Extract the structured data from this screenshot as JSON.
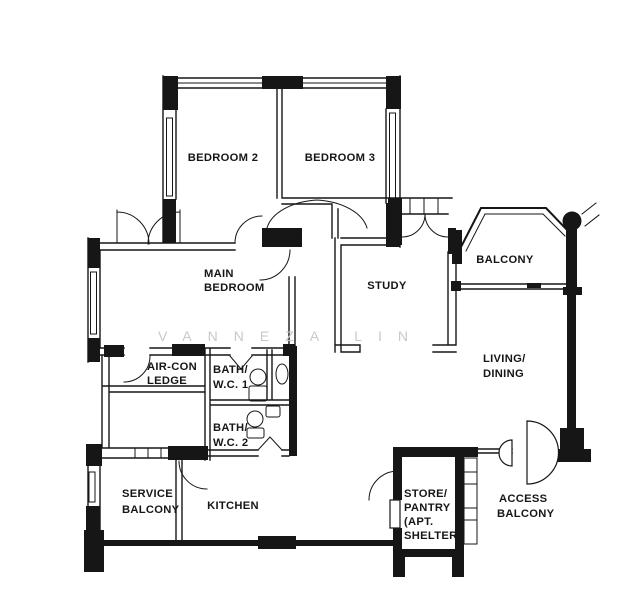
{
  "colors": {
    "wall": "#161616",
    "label": "#161616",
    "watermark": "#c9c9c9",
    "background": "#ffffff"
  },
  "watermark": {
    "text": "VANNEZA LIN"
  },
  "rooms": {
    "bedroom2": {
      "lines": [
        "BEDROOM 2"
      ]
    },
    "bedroom3": {
      "lines": [
        "BEDROOM 3"
      ]
    },
    "main_bedroom": {
      "lines": [
        "MAIN",
        "BEDROOM"
      ]
    },
    "study": {
      "lines": [
        "STUDY"
      ]
    },
    "balcony": {
      "lines": [
        "BALCONY"
      ]
    },
    "living_dining": {
      "lines": [
        "LIVING/",
        "DINING"
      ]
    },
    "aircon_ledge": {
      "lines": [
        "AIR-CON",
        "LEDGE"
      ]
    },
    "bath_wc_1": {
      "lines": [
        "BATH/",
        "W.C. 1"
      ]
    },
    "bath_wc_2": {
      "lines": [
        "BATH/",
        "W.C. 2"
      ]
    },
    "service_balcony": {
      "lines": [
        "SERVICE",
        "BALCONY"
      ]
    },
    "kitchen": {
      "lines": [
        "KITCHEN"
      ]
    },
    "store_pantry": {
      "lines": [
        "STORE/",
        "PANTRY",
        "(APT.",
        "SHELTER"
      ]
    },
    "access_balcony": {
      "lines": [
        "ACCESS",
        "BALCONY"
      ]
    }
  },
  "icons": {
    "door_swing": "quarter-circle-arc",
    "double_door_swing": "twin-arcs",
    "casement_window": "twin-fan-arcs",
    "bifold_door": "v-triangle",
    "toilet": "circle-with-tank",
    "wash_basin": "ellipse",
    "column": "filled-circle",
    "entrance_door": "semicircle-leaves"
  }
}
